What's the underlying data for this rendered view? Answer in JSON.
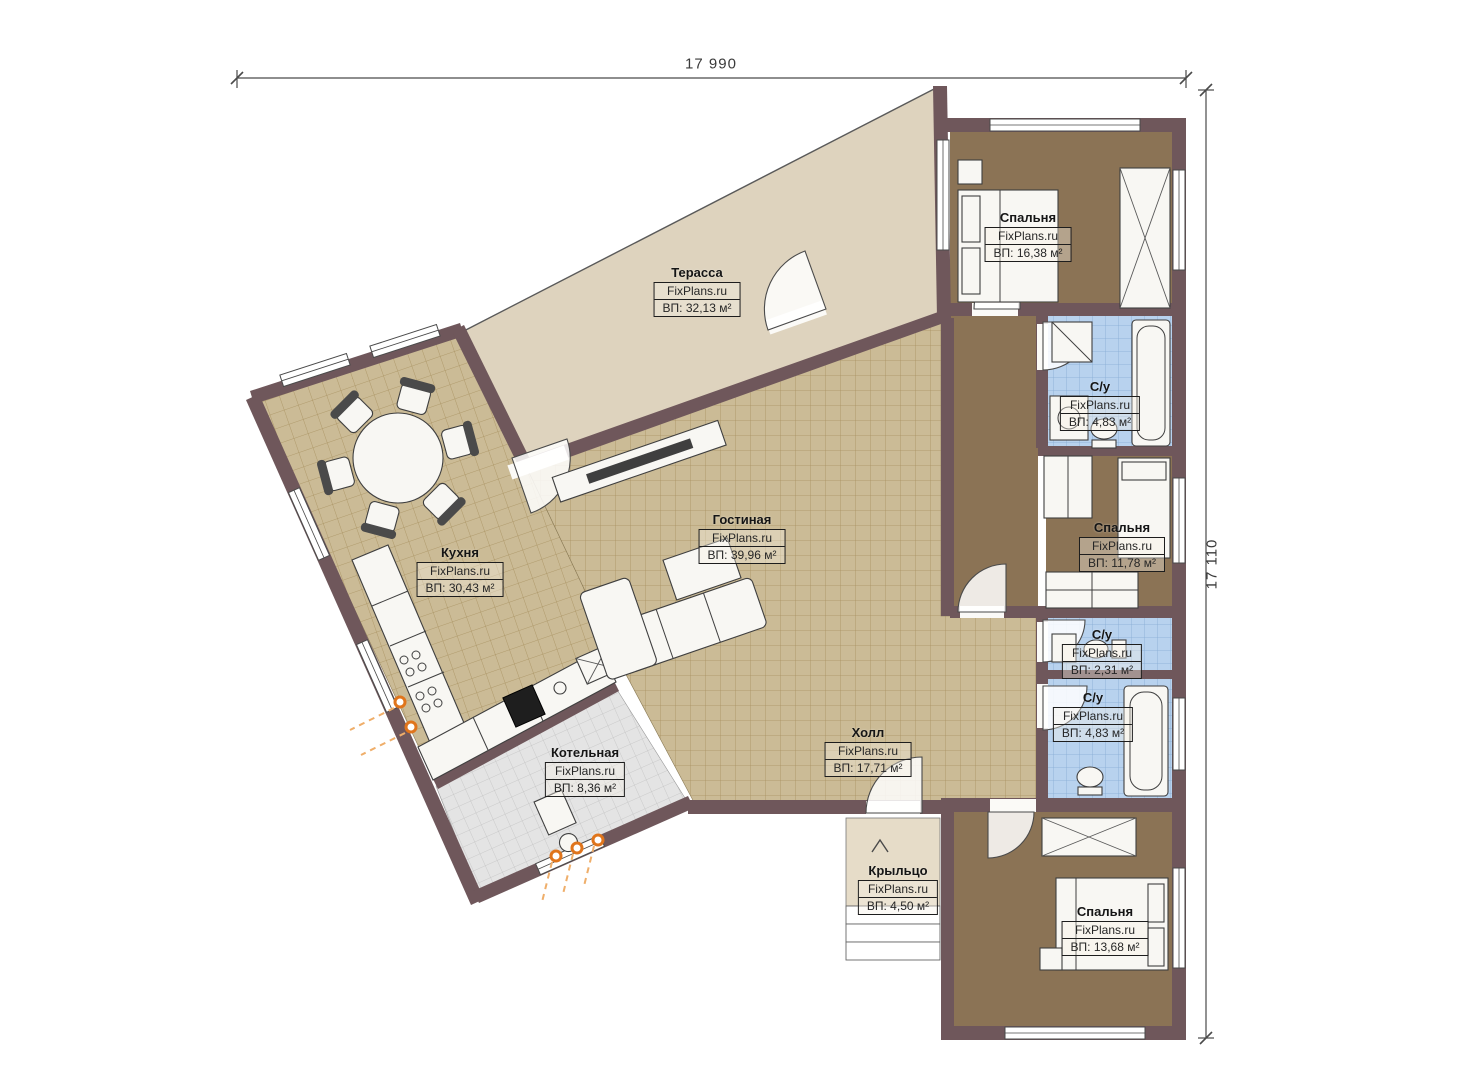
{
  "watermark": "FixPlans.ru",
  "dimensions": {
    "top": "17 990",
    "right": "17 110"
  },
  "colors": {
    "wall": "#6f575b",
    "terrace_floor": "#ded3be",
    "tile_floor": "#cbbb96",
    "bedroom_floor": "#8b7355",
    "bathroom_floor": "#b8d2ee",
    "boiler_floor": "#e4e4e4",
    "porch_floor": "#e6dcc8",
    "accent_orange": "#e0751c"
  },
  "rooms": [
    {
      "id": "terrace",
      "name": "Терасса",
      "brand": "FixPlans.ru",
      "area": "ВП: 32,13 м²"
    },
    {
      "id": "kitchen",
      "name": "Кухня",
      "brand": "FixPlans.ru",
      "area": "ВП: 30,43 м²"
    },
    {
      "id": "living",
      "name": "Гостиная",
      "brand": "FixPlans.ru",
      "area": "ВП: 39,96 м²"
    },
    {
      "id": "hall",
      "name": "Холл",
      "brand": "FixPlans.ru",
      "area": "ВП: 17,71 м²"
    },
    {
      "id": "boiler",
      "name": "Котельная",
      "brand": "FixPlans.ru",
      "area": "ВП: 8,36 м²"
    },
    {
      "id": "porch",
      "name": "Крыльцо",
      "brand": "FixPlans.ru",
      "area": "ВП: 4,50 м²"
    },
    {
      "id": "bedroom-top",
      "name": "Спальня",
      "brand": "FixPlans.ru",
      "area": "ВП: 16,38 м²"
    },
    {
      "id": "bathroom-top",
      "name": "С/у",
      "brand": "FixPlans.ru",
      "area": "ВП: 4,83 м²"
    },
    {
      "id": "bedroom-middle",
      "name": "Спальня",
      "brand": "FixPlans.ru",
      "area": "ВП: 11,78 м²"
    },
    {
      "id": "bathroom-small",
      "name": "С/у",
      "brand": "FixPlans.ru",
      "area": "ВП: 2,31 м²"
    },
    {
      "id": "bathroom-lower",
      "name": "С/у",
      "brand": "FixPlans.ru",
      "area": "ВП: 4,83 м²"
    },
    {
      "id": "bedroom-bottom",
      "name": "Спальня",
      "brand": "FixPlans.ru",
      "area": "ВП: 13,68 м²"
    }
  ]
}
